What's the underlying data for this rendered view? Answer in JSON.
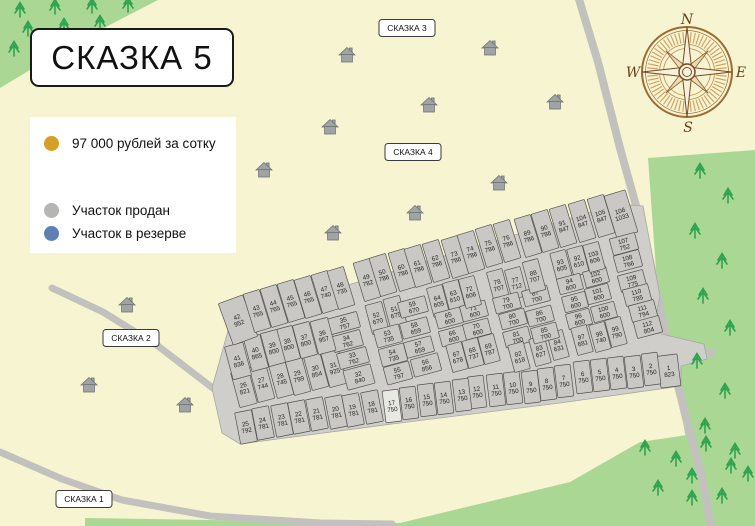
{
  "title": "СКАЗКА 5",
  "legend": {
    "price": {
      "label": "97 000 рублей за сотку",
      "color": "#d2a125"
    },
    "sold": {
      "label": "Участок продан",
      "color": "#b5b5b3"
    },
    "reserved": {
      "label": "Участок в резерве",
      "color": "#5d7fb2"
    }
  },
  "map_labels": [
    {
      "text": "СКАЗКА 1",
      "x": 84,
      "y": 499
    },
    {
      "text": "СКАЗКА 2",
      "x": 131,
      "y": 338
    },
    {
      "text": "СКАЗКА 3",
      "x": 407,
      "y": 28
    },
    {
      "text": "СКАЗКА 4",
      "x": 413,
      "y": 152
    }
  ],
  "compass": {
    "n": "N",
    "e": "E",
    "s": "S",
    "w": "W",
    "cx": 687,
    "cy": 72
  },
  "colors": {
    "background": "#f7f4d2",
    "forest": "#abd795",
    "tree": "#2ea34f",
    "road": "#c2c1bd",
    "district": "#cfcecb",
    "plot_fill": "#c9c8c4",
    "plot_stroke": "#55524e",
    "plot_text": "#211f1c",
    "house": "#a0a4a4"
  },
  "plots": [
    [
      1,
      823,
      669,
      371,
      20,
      32,
      -7
    ],
    [
      2,
      750,
      651,
      369,
      16,
      32,
      -7
    ],
    [
      3,
      750,
      634,
      372,
      16,
      32,
      -7
    ],
    [
      4,
      750,
      617,
      373,
      16,
      32,
      -7
    ],
    [
      5,
      750,
      600,
      375,
      16,
      32,
      -7
    ],
    [
      6,
      750,
      583,
      377,
      16,
      32,
      -7
    ],
    [
      7,
      750,
      564,
      381,
      16,
      32,
      -7
    ],
    [
      8,
      750,
      547,
      384,
      16,
      32,
      -7
    ],
    [
      9,
      750,
      531,
      387,
      16,
      32,
      -7
    ],
    [
      10,
      750,
      513,
      388,
      16,
      32,
      -7
    ],
    [
      11,
      750,
      496,
      390,
      16,
      32,
      -7
    ],
    [
      12,
      750,
      477,
      392,
      16,
      32,
      -7
    ],
    [
      13,
      750,
      462,
      395,
      16,
      32,
      -7
    ],
    [
      14,
      750,
      444,
      398,
      16,
      32,
      -7
    ],
    [
      15,
      750,
      427,
      400,
      16,
      32,
      -7
    ],
    [
      16,
      750,
      409,
      403,
      16,
      32,
      -7
    ],
    [
      17,
      750,
      392,
      406,
      16,
      32,
      -7,
      "#e9e9e4"
    ],
    [
      18,
      781,
      372,
      407,
      17,
      32,
      -11
    ],
    [
      19,
      781,
      353,
      410,
      17,
      32,
      -11
    ],
    [
      20,
      781,
      336,
      412,
      17,
      32,
      -11
    ],
    [
      21,
      781,
      317,
      414,
      17,
      32,
      -11
    ],
    [
      22,
      781,
      299,
      417,
      17,
      32,
      -11
    ],
    [
      23,
      781,
      282,
      420,
      17,
      32,
      -11
    ],
    [
      24,
      781,
      263,
      423,
      17,
      32,
      -11
    ],
    [
      25,
      792,
      246,
      427,
      17,
      32,
      -11
    ],
    [
      26,
      821,
      244,
      388,
      18,
      36,
      -15
    ],
    [
      27,
      744,
      262,
      383,
      17,
      36,
      -15
    ],
    [
      28,
      745,
      281,
      379,
      17,
      36,
      -15
    ],
    [
      29,
      799,
      298,
      376,
      17,
      36,
      -15
    ],
    [
      30,
      854,
      316,
      371,
      17,
      36,
      -15
    ],
    [
      31,
      925,
      334,
      368,
      18,
      36,
      -15
    ],
    [
      32,
      840,
      359,
      377,
      28,
      20,
      -15
    ],
    [
      33,
      762,
      353,
      358,
      30,
      16,
      -15
    ],
    [
      34,
      762,
      347,
      341,
      30,
      16,
      -15
    ],
    [
      35,
      757,
      344,
      323,
      30,
      16,
      -15
    ],
    [
      36,
      957,
      323,
      336,
      18,
      34,
      -15
    ],
    [
      37,
      800,
      305,
      340,
      17,
      34,
      -15
    ],
    [
      38,
      800,
      288,
      344,
      17,
      34,
      -15
    ],
    [
      39,
      800,
      273,
      348,
      17,
      34,
      -15
    ],
    [
      40,
      865,
      256,
      353,
      17,
      34,
      -15
    ],
    [
      41,
      836,
      238,
      361,
      19,
      34,
      -15
    ],
    [
      42,
      952,
      238,
      320,
      26,
      44,
      -20
    ],
    [
      43,
      765,
      257,
      311,
      17,
      40,
      -17
    ],
    [
      44,
      765,
      274,
      306,
      17,
      40,
      -17
    ],
    [
      45,
      765,
      291,
      301,
      17,
      40,
      -17
    ],
    [
      46,
      765,
      308,
      297,
      17,
      40,
      -17
    ],
    [
      47,
      740,
      325,
      292,
      17,
      40,
      -17
    ],
    [
      48,
      735,
      341,
      288,
      17,
      40,
      -17
    ],
    [
      49,
      782,
      367,
      280,
      17,
      40,
      -17
    ],
    [
      50,
      786,
      383,
      275,
      17,
      40,
      -17
    ],
    [
      51,
      675,
      395,
      312,
      17,
      30,
      -15
    ],
    [
      52,
      670,
      377,
      318,
      17,
      30,
      -15
    ],
    [
      53,
      735,
      388,
      336,
      26,
      18,
      -15
    ],
    [
      54,
      735,
      393,
      355,
      26,
      18,
      -15
    ],
    [
      55,
      797,
      398,
      373,
      26,
      18,
      -15
    ],
    [
      56,
      856,
      426,
      365,
      28,
      18,
      -15
    ],
    [
      57,
      659,
      419,
      347,
      28,
      16,
      -15
    ],
    [
      58,
      659,
      415,
      328,
      28,
      16,
      -15
    ],
    [
      59,
      670,
      413,
      307,
      28,
      16,
      -15
    ],
    [
      60,
      786,
      402,
      270,
      17,
      40,
      -17
    ],
    [
      61,
      786,
      418,
      266,
      17,
      40,
      -17
    ],
    [
      62,
      786,
      436,
      261,
      17,
      40,
      -17
    ],
    [
      63,
      610,
      454,
      296,
      16,
      30,
      -15
    ],
    [
      64,
      605,
      438,
      301,
      16,
      30,
      -15
    ],
    [
      65,
      600,
      449,
      318,
      26,
      16,
      -15
    ],
    [
      66,
      600,
      453,
      336,
      26,
      16,
      -15
    ],
    [
      67,
      678,
      457,
      357,
      16,
      28,
      -15
    ],
    [
      68,
      737,
      473,
      353,
      16,
      28,
      -15
    ],
    [
      69,
      787,
      489,
      349,
      16,
      28,
      -15
    ],
    [
      70,
      600,
      477,
      329,
      26,
      16,
      -15
    ],
    [
      71,
      600,
      474,
      311,
      26,
      16,
      -15
    ],
    [
      72,
      606,
      470,
      292,
      16,
      30,
      -15
    ],
    [
      73,
      786,
      455,
      257,
      17,
      40,
      -17
    ],
    [
      74,
      786,
      471,
      252,
      17,
      40,
      -17
    ],
    [
      75,
      786,
      489,
      246,
      17,
      40,
      -17
    ],
    [
      76,
      786,
      507,
      241,
      17,
      40,
      -17
    ],
    [
      77,
      712,
      516,
      283,
      16,
      30,
      -15
    ],
    [
      78,
      707,
      498,
      285,
      16,
      30,
      -15
    ],
    [
      79,
      700,
      507,
      303,
      26,
      16,
      -15
    ],
    [
      80,
      700,
      513,
      319,
      26,
      16,
      -15
    ],
    [
      81,
      700,
      517,
      337,
      26,
      16,
      -15
    ],
    [
      82,
      618,
      519,
      357,
      16,
      28,
      -15
    ],
    [
      83,
      627,
      540,
      351,
      16,
      28,
      -15
    ],
    [
      84,
      631,
      558,
      345,
      16,
      28,
      -15
    ],
    [
      85,
      700,
      545,
      333,
      26,
      16,
      -15
    ],
    [
      86,
      700,
      540,
      316,
      26,
      16,
      -15
    ],
    [
      87,
      700,
      536,
      296,
      26,
      16,
      -15
    ],
    [
      88,
      707,
      534,
      276,
      16,
      32,
      -15
    ],
    [
      89,
      786,
      528,
      236,
      17,
      40,
      -17
    ],
    [
      90,
      786,
      545,
      231,
      17,
      40,
      -17
    ],
    [
      91,
      847,
      563,
      226,
      17,
      40,
      -17
    ],
    [
      92,
      610,
      578,
      261,
      16,
      28,
      -15
    ],
    [
      93,
      605,
      561,
      265,
      16,
      28,
      -15
    ],
    [
      94,
      600,
      570,
      284,
      24,
      16,
      -15
    ],
    [
      95,
      600,
      575,
      302,
      24,
      16,
      -15
    ],
    [
      96,
      600,
      579,
      319,
      24,
      16,
      -15
    ],
    [
      97,
      681,
      582,
      340,
      16,
      28,
      -15
    ],
    [
      98,
      740,
      600,
      337,
      16,
      28,
      -15
    ],
    [
      99,
      790,
      616,
      332,
      16,
      28,
      -15
    ],
    [
      100,
      600,
      604,
      312,
      24,
      16,
      -15
    ],
    [
      101,
      600,
      598,
      294,
      24,
      16,
      -15
    ],
    [
      102,
      600,
      596,
      277,
      24,
      16,
      -15
    ],
    [
      103,
      606,
      594,
      257,
      16,
      28,
      -15
    ],
    [
      104,
      847,
      582,
      221,
      17,
      40,
      -17
    ],
    [
      105,
      847,
      601,
      216,
      17,
      40,
      -17
    ],
    [
      106,
      1033,
      621,
      214,
      22,
      44,
      -17
    ],
    [
      107,
      752,
      624,
      244,
      26,
      17,
      -15
    ],
    [
      108,
      766,
      628,
      261,
      26,
      17,
      -15
    ],
    [
      109,
      775,
      632,
      281,
      26,
      17,
      -15
    ],
    [
      110,
      785,
      637,
      295,
      26,
      17,
      -15
    ],
    [
      111,
      794,
      643,
      311,
      26,
      17,
      -15
    ],
    [
      112,
      804,
      648,
      327,
      26,
      17,
      -15
    ]
  ],
  "houses": [
    [
      347,
      55
    ],
    [
      490,
      48
    ],
    [
      429,
      105
    ],
    [
      555,
      102
    ],
    [
      330,
      127
    ],
    [
      264,
      170
    ],
    [
      499,
      183
    ],
    [
      415,
      213
    ],
    [
      333,
      233
    ],
    [
      127,
      305
    ],
    [
      89,
      385
    ],
    [
      185,
      405
    ]
  ],
  "trees": [
    [
      20,
      14
    ],
    [
      55,
      11
    ],
    [
      92,
      10
    ],
    [
      128,
      9
    ],
    [
      28,
      33
    ],
    [
      64,
      30
    ],
    [
      100,
      27
    ],
    [
      14,
      53
    ],
    [
      46,
      49
    ],
    [
      700,
      175
    ],
    [
      728,
      200
    ],
    [
      695,
      235
    ],
    [
      722,
      265
    ],
    [
      703,
      300
    ],
    [
      730,
      332
    ],
    [
      697,
      365
    ],
    [
      725,
      395
    ],
    [
      705,
      430
    ],
    [
      735,
      455
    ],
    [
      692,
      480
    ],
    [
      722,
      500
    ],
    [
      645,
      452
    ],
    [
      676,
      463
    ],
    [
      706,
      448
    ],
    [
      731,
      470
    ],
    [
      658,
      492
    ],
    [
      692,
      502
    ],
    [
      748,
      478
    ]
  ]
}
